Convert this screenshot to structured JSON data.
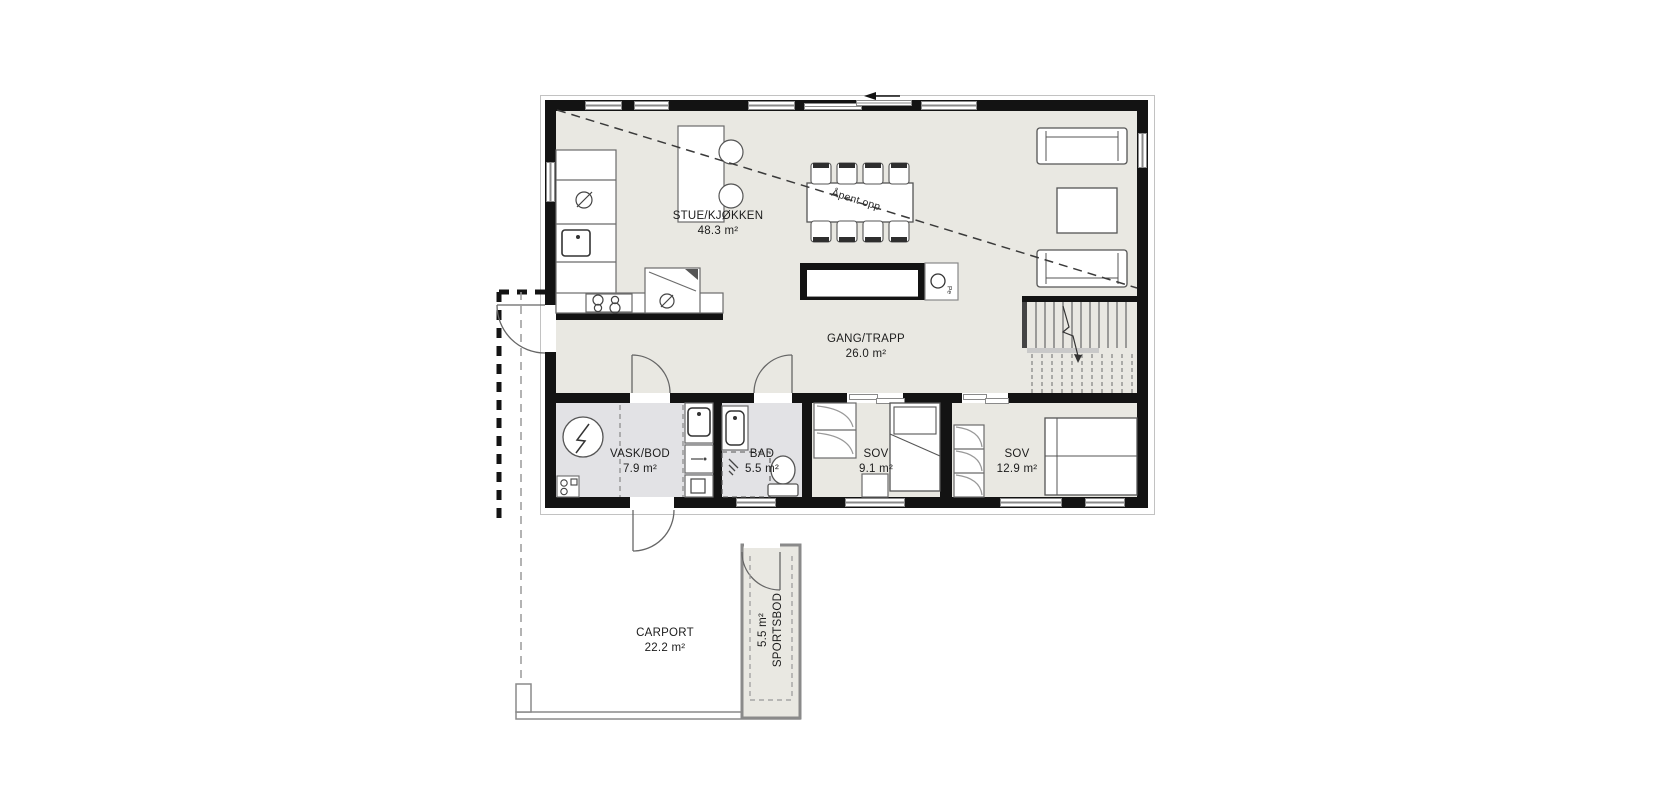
{
  "plan": {
    "rooms": [
      {
        "id": "stue-kjokken",
        "name": "STUE/KJØKKEN",
        "area": "48.3 m²"
      },
      {
        "id": "gang-trapp",
        "name": "GANG/TRAPP",
        "area": "26.0 m²"
      },
      {
        "id": "vask-bod",
        "name": "VASK/BOD",
        "area": "7.9 m²"
      },
      {
        "id": "bad",
        "name": "BAD",
        "area": "5.5 m²"
      },
      {
        "id": "sov-1",
        "name": "SOV",
        "area": "9.1 m²"
      },
      {
        "id": "sov-2",
        "name": "SOV",
        "area": "12.9 m²"
      },
      {
        "id": "carport",
        "name": "CARPORT",
        "area": "22.2 m²"
      },
      {
        "id": "sportsbod",
        "name": "SPORTSBOD",
        "area": "5.5 m²"
      }
    ],
    "annotations": {
      "open_above": "Åpent opp",
      "fireplace": "Pe"
    },
    "colors": {
      "wall": "#131313",
      "floor": "#e9e8e2",
      "wet_floor": "#e2e2e5",
      "outline": "#8a8a8a"
    }
  }
}
